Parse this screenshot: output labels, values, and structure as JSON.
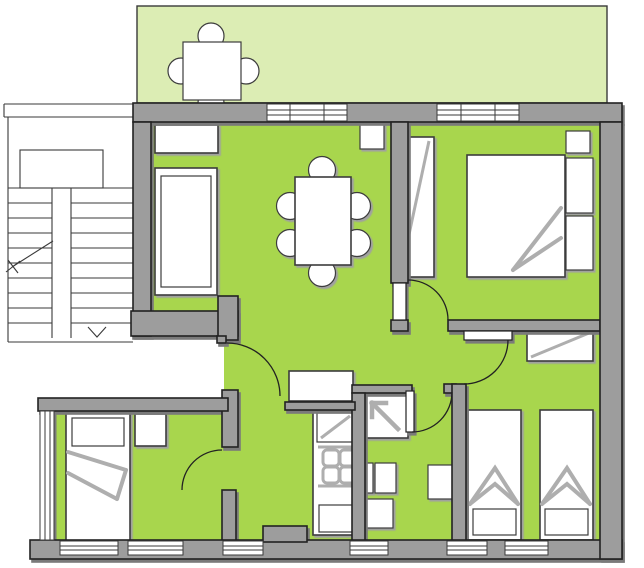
{
  "document": {
    "type": "architectural-floor-plan",
    "visible_text": []
  },
  "colors": {
    "background": "#ffffff",
    "room_fill": "#a8d64d",
    "balcony_fill": "#dcedb4",
    "wall_fill": "#9d9d9d",
    "wall_outline": "#222222",
    "wall_shadow": "#7a7a7a",
    "furniture_fill": "#ffffff",
    "furniture_outline": "#3c3c3c",
    "furniture_shadow": "#a0a0a0",
    "soft_line": "#aeaeae",
    "thin_line": "#3a3a3a"
  },
  "plan": {
    "areas": [
      {
        "name": "balcony",
        "fill": "balcony_fill",
        "furniture": [
          "balcony-table",
          "balcony-chairs"
        ]
      },
      {
        "name": "stairwell",
        "fill": "background",
        "symbols": [
          "stair-flights",
          "landing",
          "up-direction-line",
          "down-arrow"
        ]
      },
      {
        "name": "living-dining-room",
        "fill": "room_fill",
        "furniture": [
          "shelf",
          "sofa",
          "doormat",
          "dining-table",
          "six-chairs"
        ]
      },
      {
        "name": "bedroom-top-right",
        "fill": "room_fill",
        "furniture": [
          "wardrobe",
          "double-bed",
          "nightstands"
        ]
      },
      {
        "name": "hallway",
        "fill": "room_fill",
        "furniture": [
          "sideboard"
        ]
      },
      {
        "name": "kitchen-niche",
        "fill": "room_fill",
        "furniture": [
          "counter",
          "sink-unit",
          "stove",
          "lower-cabinet"
        ]
      },
      {
        "name": "bathroom",
        "fill": "room_fill",
        "furniture": [
          "shower",
          "wc",
          "washbasin-left",
          "washbasin-right"
        ]
      },
      {
        "name": "bedroom-bottom-left",
        "fill": "room_fill",
        "furniture": [
          "single-bed",
          "nightstand"
        ]
      },
      {
        "name": "bedroom-bottom-right",
        "fill": "room_fill",
        "furniture": [
          "wardrobe",
          "twin-bed-left",
          "twin-bed-right"
        ]
      }
    ],
    "doors": [
      "entry-door",
      "bedroom-top-right-door",
      "bedroom-bottom-right-door",
      "bathroom-door",
      "bedroom-bottom-left-door"
    ],
    "windows": [
      "top-wall-window-1",
      "top-wall-window-2",
      "left-wall-window",
      "bottom-window-1a",
      "bottom-window-1b",
      "bottom-window-2",
      "bottom-window-3",
      "bottom-window-4",
      "bottom-window-5"
    ]
  }
}
